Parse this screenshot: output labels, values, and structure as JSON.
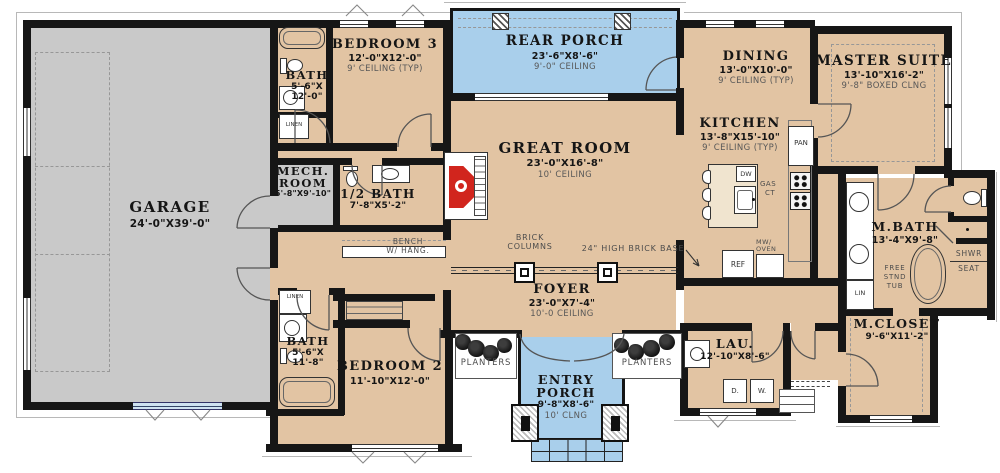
{
  "colors": {
    "floor_beige": "#e2c4a3",
    "floor_gray": "#c9c9c9",
    "porch_blue": "#a9cfeb",
    "wall_black": "#161616",
    "fireplace_red": "#d1251d"
  },
  "rooms": {
    "garage": {
      "name": "GARAGE",
      "dims": "24'-0\"X39'-0\""
    },
    "bedroom3": {
      "name": "BEDROOM 3",
      "dims": "12'-0\"X12'-0\"",
      "ceiling": "9' CEILING (TYP)"
    },
    "bath_top": {
      "name": "BATH",
      "dims1": "5'-6\"X",
      "dims2": "12'-0\""
    },
    "mech_room": {
      "name1": "MECH.",
      "name2": "ROOM",
      "dims": "5'-8\"X9'-10\""
    },
    "half_bath": {
      "name": "1/2 BATH",
      "dims": "7'-8\"X5'-2\""
    },
    "rear_porch": {
      "name": "REAR PORCH",
      "dims": "23'-6\"X8'-6\"",
      "ceiling": "9'-0\" CEILING"
    },
    "great_room": {
      "name": "GREAT ROOM",
      "dims": "23'-0\"X16'-8\"",
      "ceiling": "10' CEILING"
    },
    "dining": {
      "name": "DINING",
      "dims": "13'-0\"X10'-0\"",
      "ceiling": "9' CEILING (TYP)"
    },
    "kitchen": {
      "name": "KITCHEN",
      "dims": "13'-8\"X15'-10\"",
      "ceiling": "9' CEILING (TYP)"
    },
    "master_suite": {
      "name": "MASTER SUITE",
      "dims": "13'-10\"X16'-2\"",
      "ceiling": "9'-8\" BOXED CLNG"
    },
    "master_bath": {
      "name": "M.BATH",
      "dims": "13'-4\"X9'-8\""
    },
    "master_closet": {
      "name": "M.CLOSET",
      "dims": "9'-6\"X11'-2\""
    },
    "foyer": {
      "name": "FOYER",
      "dims": "23'-0\"X7'-4\"",
      "ceiling": "10'-0 CEILING"
    },
    "bath_lower": {
      "name": "BATH",
      "dims1": "5'-6\"X",
      "dims2": "11'-8\""
    },
    "bedroom2": {
      "name": "BEDROOM 2",
      "dims": "11'-10\"X12'-0\""
    },
    "laundry": {
      "name": "LAU.",
      "dims": "12'-10\"X8'-6\""
    },
    "entry_porch": {
      "name1": "ENTRY",
      "name2": "PORCH",
      "dims": "9'-8\"X8'-6\"",
      "ceiling": "10' CLNG"
    }
  },
  "labels": {
    "linen_top": "LINEN",
    "linen_lower": "LINEN",
    "lin": "LIN",
    "bench1": "BENCH",
    "bench2": "W/ HANG.",
    "brick_col1": "BRICK",
    "brick_col2": "COLUMNS",
    "brick_base": "24\" HIGH BRICK BASE",
    "planters_left": "PLANTERS",
    "planters_right": "PLANTERS",
    "pan": "PAN",
    "dw": "DW",
    "ref": "REF",
    "mw1": "MW/",
    "mw2": "OVEN",
    "gas1": "GAS",
    "gas2": "CT",
    "dryer": "D.",
    "washer": "W.",
    "free1": "FREE",
    "free2": "STND",
    "free3": "TUB",
    "shwr": "SHWR",
    "seat": "SEAT"
  }
}
